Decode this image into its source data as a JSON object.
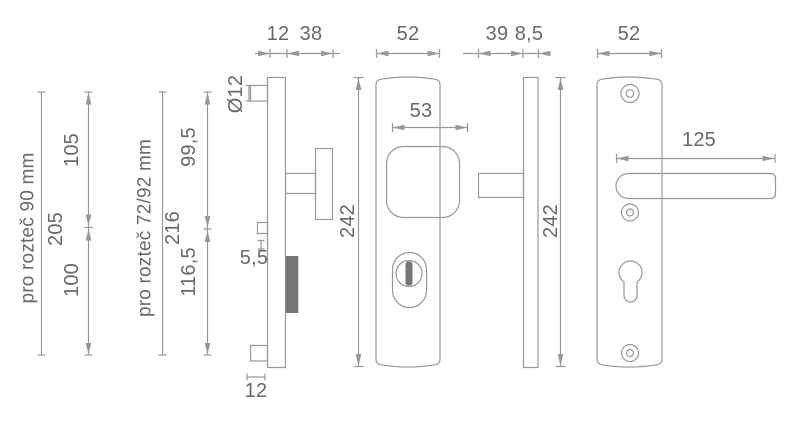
{
  "title": "Security door fitting dimensional drawing",
  "colors": {
    "background": "#ffffff",
    "line": "#97989b",
    "text": "#67686b",
    "dark_fill": "#747577"
  },
  "reference_groups": [
    {
      "label": "pro rozteč 90 mm",
      "top": "105",
      "total": "205",
      "bottom": "100"
    },
    {
      "label": "pro rozteč 72/92 mm",
      "top": "99,5",
      "total": "216",
      "bottom": "116,5"
    }
  ],
  "views": {
    "outer_side": {
      "plate_thickness": "12",
      "knob_projection": "38",
      "pin_diameter": "Ø12",
      "stub_offset": "5,5",
      "pin_width": "12"
    },
    "outer_front": {
      "width": "52",
      "knob_width": "53",
      "height": "242"
    },
    "inner_side": {
      "spindle_projection": "39",
      "plate_thickness": "8,5"
    },
    "inner_front": {
      "width": "52",
      "lever_length": "125",
      "height": "242"
    }
  }
}
